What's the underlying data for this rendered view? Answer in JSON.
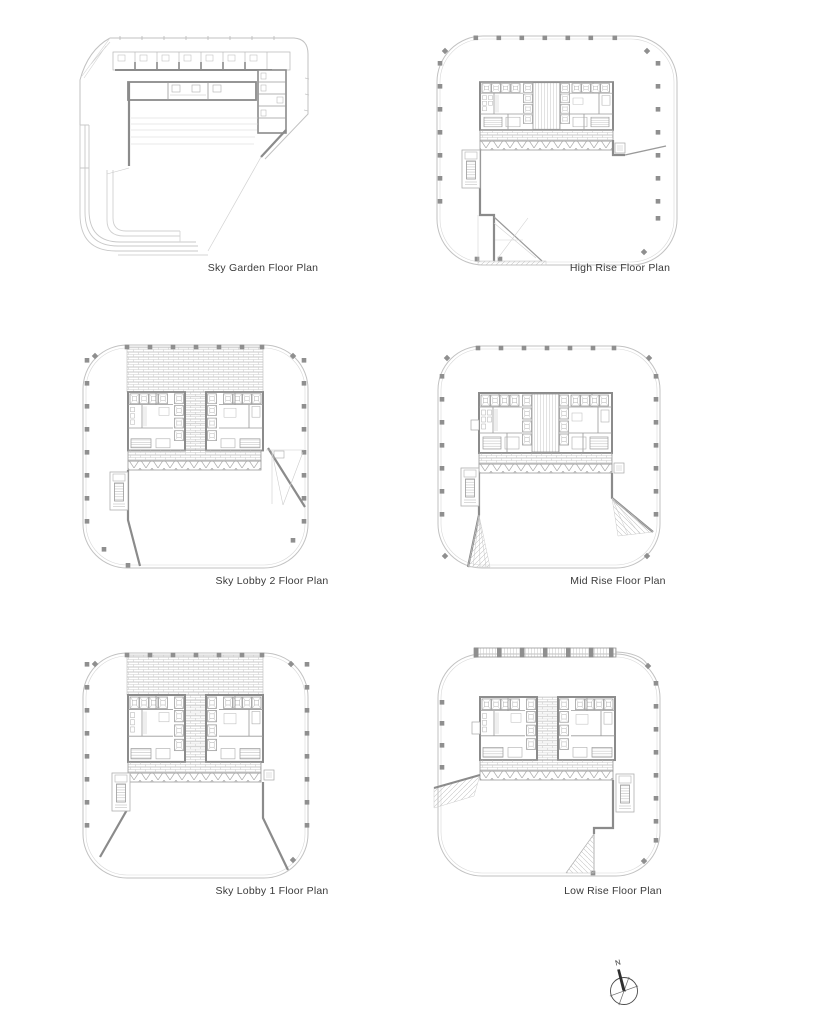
{
  "plans": [
    {
      "id": "sky-garden",
      "label": "Sky Garden Floor Plan"
    },
    {
      "id": "high-rise",
      "label": "High Rise Floor Plan"
    },
    {
      "id": "sky-lobby-2",
      "label": "Sky Lobby 2 Floor Plan"
    },
    {
      "id": "mid-rise",
      "label": "Mid Rise Floor Plan"
    },
    {
      "id": "sky-lobby-1",
      "label": "Sky Lobby 1 Floor Plan"
    },
    {
      "id": "low-rise",
      "label": "Low Rise Floor Plan"
    }
  ],
  "compass": {
    "north_label": "N"
  },
  "colors": {
    "background": "#ffffff",
    "line_light": "#c6c6c6",
    "line_medium": "#9a9a9a",
    "wall_dark": "#8b8b8b",
    "column": "#8f8f8f",
    "label_text": "#3a3a3a",
    "compass_ink": "#3a3a3a"
  }
}
